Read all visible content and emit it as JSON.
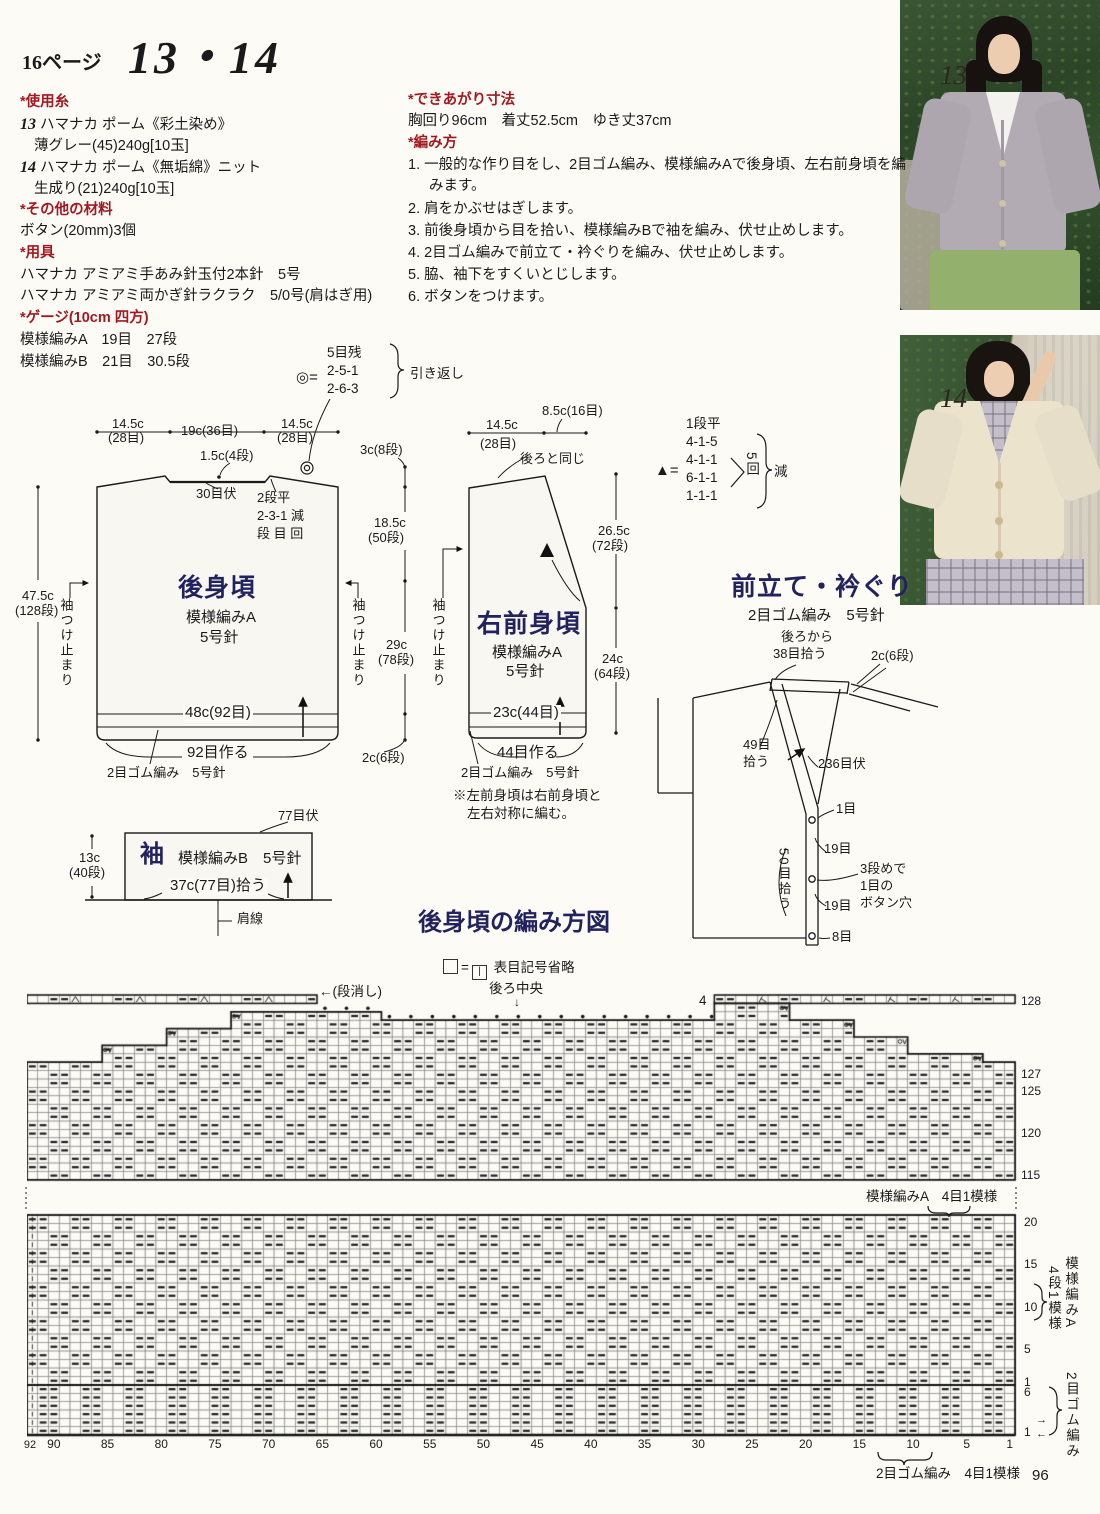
{
  "page": {
    "ref": "16ページ",
    "title": "13・14",
    "number": "96"
  },
  "photos": {
    "tag13": "13",
    "tag14": "14"
  },
  "materials": {
    "yarn_h": "*使用糸",
    "items": [
      {
        "no": "13",
        "name": "ハマナカ ポーム《彩土染め》",
        "detail": "薄グレー(45)240g[10玉]"
      },
      {
        "no": "14",
        "name": "ハマナカ ポーム《無垢綿》ニット",
        "detail": "生成り(21)240g[10玉]"
      }
    ],
    "other_h": "*その他の材料",
    "other": "ボタン(20mm)3個",
    "tools_h": "*用具",
    "tools": [
      "ハマナカ アミアミ手あみ針玉付2本針　5号",
      "ハマナカ アミアミ両かぎ針ラクラク　5/0号(肩はぎ用)"
    ],
    "gauge_h": "*ゲージ(10cm 四方)",
    "gauges": [
      "模様編みA　19目　27段",
      "模様編みB　21目　30.5段"
    ]
  },
  "finished": {
    "h": "*できあがり寸法",
    "size": "胸回り96cm　着丈52.5cm　ゆき丈37cm"
  },
  "howto": {
    "h": "*編み方",
    "steps": [
      {
        "n": "1.",
        "t": "一般的な作り目をし、2目ゴム編み、模様編みAで後身頃、左右前身頃を編みます。"
      },
      {
        "n": "2.",
        "t": "肩をかぶせはぎします。"
      },
      {
        "n": "3.",
        "t": "前後身頃から目を拾い、模様編みBで袖を編み、伏せ止めします。"
      },
      {
        "n": "4.",
        "t": "2目ゴム編みで前立て・衿ぐりを編み、伏せ止めします。"
      },
      {
        "n": "5.",
        "t": "脇、袖下をすくいとじします。"
      },
      {
        "n": "6.",
        "t": "ボタンをつけます。"
      }
    ]
  },
  "turnback": {
    "sym": "◎=",
    "l1": "5目残",
    "l2": "2-5-1",
    "l3": "2-6-3",
    "note": "引き返し"
  },
  "back": {
    "name": "後身頃",
    "pat": "模様編みA",
    "needle": "5号針",
    "w_l": "14.5c",
    "w_l2": "(28目)",
    "w_c": "19c(36目)",
    "w_r": "14.5c",
    "w_r2": "(28目)",
    "neck_drop": "1.5c(4段)",
    "neck_bo": "30目伏",
    "dec1": "2段平",
    "dec2": "2-3-1 減",
    "dec3": "段 目 回",
    "len": "47.5c",
    "len2": "(128段)",
    "sleeve_stop": "袖つけ止まり",
    "m1": "3c(8段)",
    "m2": "18.5c",
    "m2b": "(50段)",
    "m3": "29c",
    "m3b": "(78段)",
    "m4": "2c(6段)",
    "w_b": "48c(92目)",
    "cast": "92目作る",
    "rib": "2目ゴム編み　5号針"
  },
  "front": {
    "name": "右前身頃",
    "pat": "模様編みA",
    "needle": "5号針",
    "w_l": "14.5c",
    "w_l2": "(28目)",
    "w_r": "8.5c(16目)",
    "same": "後ろと同じ",
    "m1": "26.5c",
    "m1b": "(72段)",
    "m2": "24c",
    "m2b": "(64段)",
    "w_b": "23c(44目)",
    "cast": "44目作る",
    "rib": "2目ゴム編み　5号針",
    "note1": "※左前身頃は右前身頃と",
    "note2": "左右対称に編む。",
    "sleeve_stop": "袖つけ止まり"
  },
  "tri": {
    "sym": "▲=",
    "l0": "1段平",
    "l1": "4-1-5",
    "l2": "4-1-1",
    "l3": "6-1-1",
    "l4": "1-1-1",
    "times": "5回",
    "dec": "減"
  },
  "band": {
    "title": "前立て・衿ぐり",
    "sub": "2目ゴム編み　5号針",
    "pick_back1": "後ろから",
    "pick_back2": "38目拾う",
    "m": "2c(6段)",
    "pick49a": "49目",
    "pick49b": "拾う",
    "bo": "236目伏",
    "st1": "1目",
    "st19a": "19目",
    "bh1": "3段めで",
    "bh2": "1目の",
    "bh3": "ボタン穴",
    "st19b": "19目",
    "st8": "8目",
    "pick50": "50目拾う"
  },
  "sleeve": {
    "name": "袖",
    "pat": "模様編みB　5号針",
    "bo": "77目伏",
    "len": "13c",
    "len2": "(40段)",
    "pick": "37c(77目)拾う",
    "shoulder": "肩線"
  },
  "chart": {
    "title": "後身頃の編み方図",
    "eq": "=",
    "knit_sym": "|",
    "knit_note": "表目記号省略",
    "center": "後ろ中央",
    "center_arrow": "↓",
    "dankeshi": "←(段消し)",
    "four": "4",
    "upper_rows": [
      "128",
      "127",
      "125",
      "120",
      "115"
    ],
    "lower_rows": [
      "20",
      "15",
      "10",
      "5",
      "1"
    ],
    "rib_rows": [
      "6",
      "1"
    ],
    "dir_up": "→",
    "dir_down": "←",
    "axis_start": "92",
    "axis": [
      "90",
      "85",
      "80",
      "75",
      "70",
      "65",
      "60",
      "55",
      "50",
      "45",
      "40",
      "35",
      "30",
      "25",
      "20",
      "15",
      "10",
      "5",
      "1"
    ],
    "patA_top": "模様編みA　4目1模様",
    "patA_side2": "4段1模様",
    "patA_side": "模様編みA",
    "rib_side": "2目ゴム編み",
    "rib_bottom": "2目ゴム編み　4目1模様"
  }
}
